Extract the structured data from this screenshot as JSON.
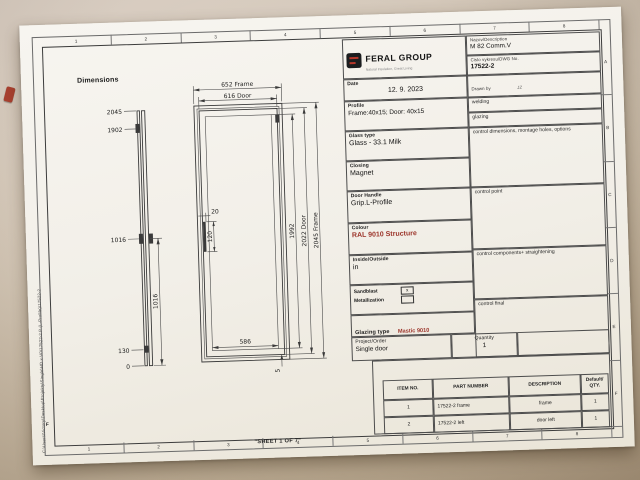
{
  "colors": {
    "accent_red": "#9c342a",
    "logo_black": "#1b1d1f",
    "paper": "#f2efe8",
    "desk": "#c7b8a4"
  },
  "sheet": {
    "label": "\"SHEET 1 OF 7\"",
    "file_path": "C:\\Users\\Victory\\Desktop\\Projekty\\Single\\HD x V0\\17522-2 P (L-Profile)\\17522-2"
  },
  "frame": {
    "zone_numbers": [
      "1",
      "2",
      "3",
      "4",
      "5",
      "6",
      "7",
      "8"
    ],
    "zone_letters": [
      "A",
      "B",
      "C",
      "D",
      "E",
      "F"
    ]
  },
  "drawing": {
    "title": "Dimensions",
    "front_view": {
      "dim_652": "652 Frame",
      "dim_616": "616 Door",
      "dim_1992": "1992",
      "dim_2022": "2022 Door",
      "dim_2045": "2045 Frame",
      "dim_586": "586",
      "dim_gap": "5",
      "dim_handle_offset": "20",
      "dim_handle_length": "120"
    },
    "side_view": {
      "ordinates": [
        "2045",
        "1902",
        "1016",
        "130",
        "0"
      ],
      "span": "1016"
    }
  },
  "title_block": {
    "brand": {
      "name": "FERAL GROUP",
      "tagline": "Natural Insulation, Great Living"
    },
    "fields": {
      "description": {
        "label": "Nazov/Description",
        "value": "M 82 Comm.V"
      },
      "dwg": {
        "label": "Cislo vykresu/DWG No.",
        "value": "17522-2"
      },
      "date": {
        "label": "Date",
        "value": "12. 9. 2023"
      },
      "drawn_by": {
        "label": "Drawn by",
        "value": "JZ"
      }
    },
    "specs": [
      {
        "label": "Profile",
        "value": "Frame:40x15; Door: 40x15"
      },
      {
        "label": "Glass type",
        "value": "Glass - 33.1 Milk"
      },
      {
        "label": "Closing",
        "value": "Magnet"
      },
      {
        "label": "Door Handle",
        "value": "Grip.L-Profile"
      },
      {
        "label": "Colour",
        "value": "RAL 9010 Structure"
      },
      {
        "label": "Inside/Outside",
        "value": "in"
      }
    ],
    "checkboxes": {
      "sandblast_label": "Sandblast",
      "sandblast_state": "x",
      "metallization_label": "Metallization"
    },
    "glazing": {
      "label": "Glazing type",
      "value": "Mastic 9010"
    },
    "project": {
      "label": "Project/Order",
      "value": "Single door"
    },
    "quantity": {
      "label": "Quantity",
      "value": "1"
    },
    "process_steps": [
      "welding",
      "glazing",
      "control dimensions, montage holes, options",
      "control point",
      "control components+ straightening",
      "control final"
    ]
  },
  "parts_table": {
    "headers": [
      "ITEM NO.",
      "PART NUMBER",
      "DESCRIPTION",
      "Default/ QTY."
    ],
    "rows": [
      [
        "1",
        "17522-2 frame",
        "frame",
        "1"
      ],
      [
        "2",
        "17522-2 left",
        "door left",
        "1"
      ]
    ]
  }
}
